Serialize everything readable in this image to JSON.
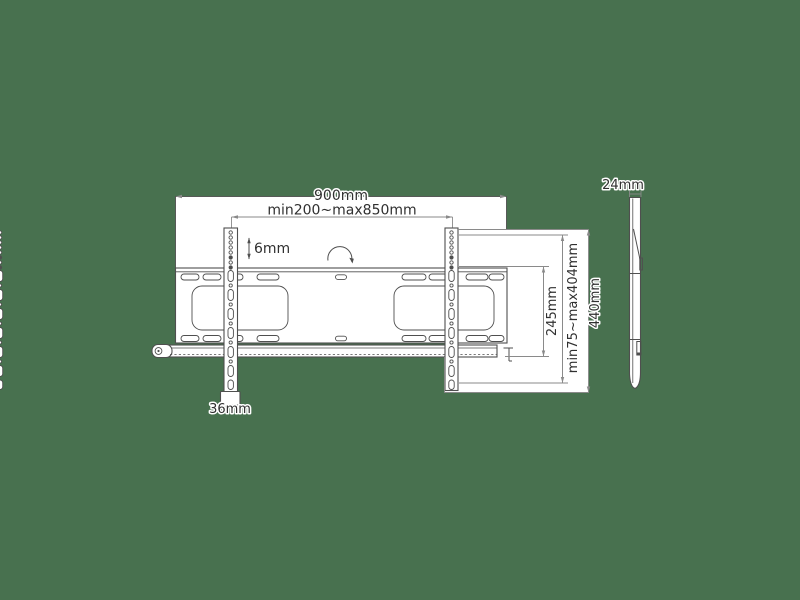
{
  "colors": {
    "background": "#48714f",
    "part_outline": "#4f4f4f",
    "part_fill": "#ffffff",
    "dimension_line": "#8a8a8a",
    "text": "#303030",
    "text_halo": "#ffffff"
  },
  "front_view": {
    "labels": {
      "overall_width": "900mm",
      "bracket_spacing_range": "min200~max850mm",
      "hole_pitch": "6mm",
      "wall_plate_height": "245mm",
      "vesa_height_range": "min75~max404mm",
      "bracket_height": "440mm",
      "bracket_width": "36mm"
    }
  },
  "side_view": {
    "labels": {
      "profile_depth": "24mm"
    }
  }
}
